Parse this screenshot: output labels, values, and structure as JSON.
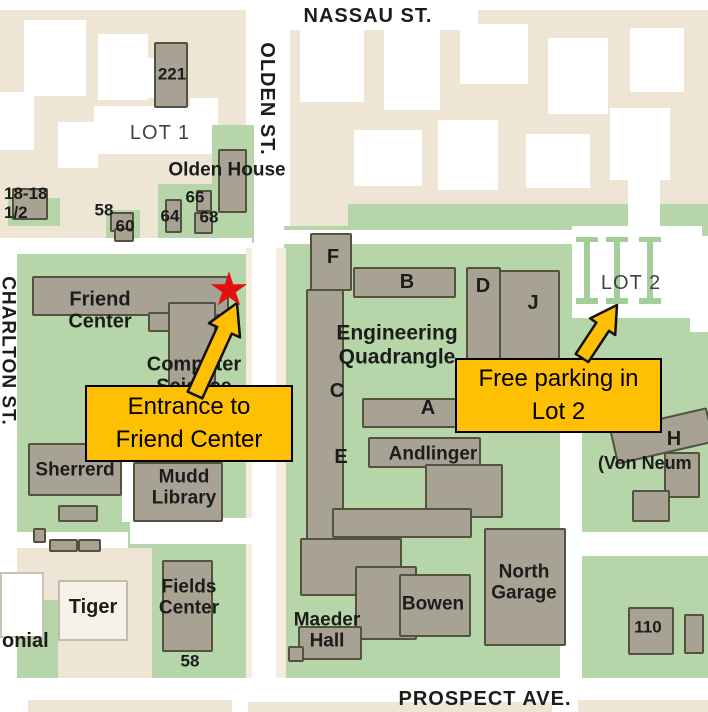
{
  "colors": {
    "map_background": "#EFE5D5",
    "road": "#FFFFFF",
    "green_space": "#B6D5A9",
    "parking_stripe": "#A5CD9A",
    "building_fill": "#A8A295",
    "building_outline": "#53523F",
    "light_building_fill": "#F7F2E9",
    "callout_fill": "#FFC003",
    "callout_border": "#000000",
    "star_red": "#E11111",
    "label_text": "#1C1C1A",
    "lot_text": "#3C444B"
  },
  "streets": {
    "nassau": "NASSAU ST.",
    "olden": "OLDEN ST.",
    "charlton": "CHARLTON ST.",
    "prospect": "PROSPECT AVE."
  },
  "lots": {
    "lot1": "LOT 1",
    "lot2": "LOT 2"
  },
  "buildings": {
    "b221": "221",
    "olden_house": "Olden House",
    "b18_and_half": "18-18\n1/2",
    "b58_olden": "58",
    "b60": "60",
    "b64": "64",
    "b66": "66",
    "b68": "68",
    "friend_center": "Friend\nCenter",
    "computer_science": "Computer\nScience",
    "engineering_quadrangle": "Engineering\nQuadrangle",
    "wing_f": "F",
    "wing_b": "B",
    "wing_c": "C",
    "wing_d": "D",
    "wing_j": "J",
    "wing_a": "A",
    "wing_e": "E",
    "wing_h": "H",
    "von_neumann_partial": "(Von Neum",
    "sherrerd": "Sherrerd",
    "mudd_library": "Mudd\nLibrary",
    "andlinger": "Andlinger",
    "tiger": "Tiger",
    "colonial_partial": "onial",
    "fields_center": "Fields\nCenter",
    "b58_prospect": "58",
    "maeder_hall": "Maeder\nHall",
    "bowen": "Bowen",
    "north_garage": "North\nGarage",
    "b110": "110"
  },
  "annotations": {
    "entrance_callout": "Entrance to\nFriend Center",
    "parking_callout": "Free parking in\nLot 2",
    "star_icon": "red-star-marker",
    "entrance_arrow_icon": "orange-arrow",
    "parking_arrow_icon": "orange-arrow"
  }
}
